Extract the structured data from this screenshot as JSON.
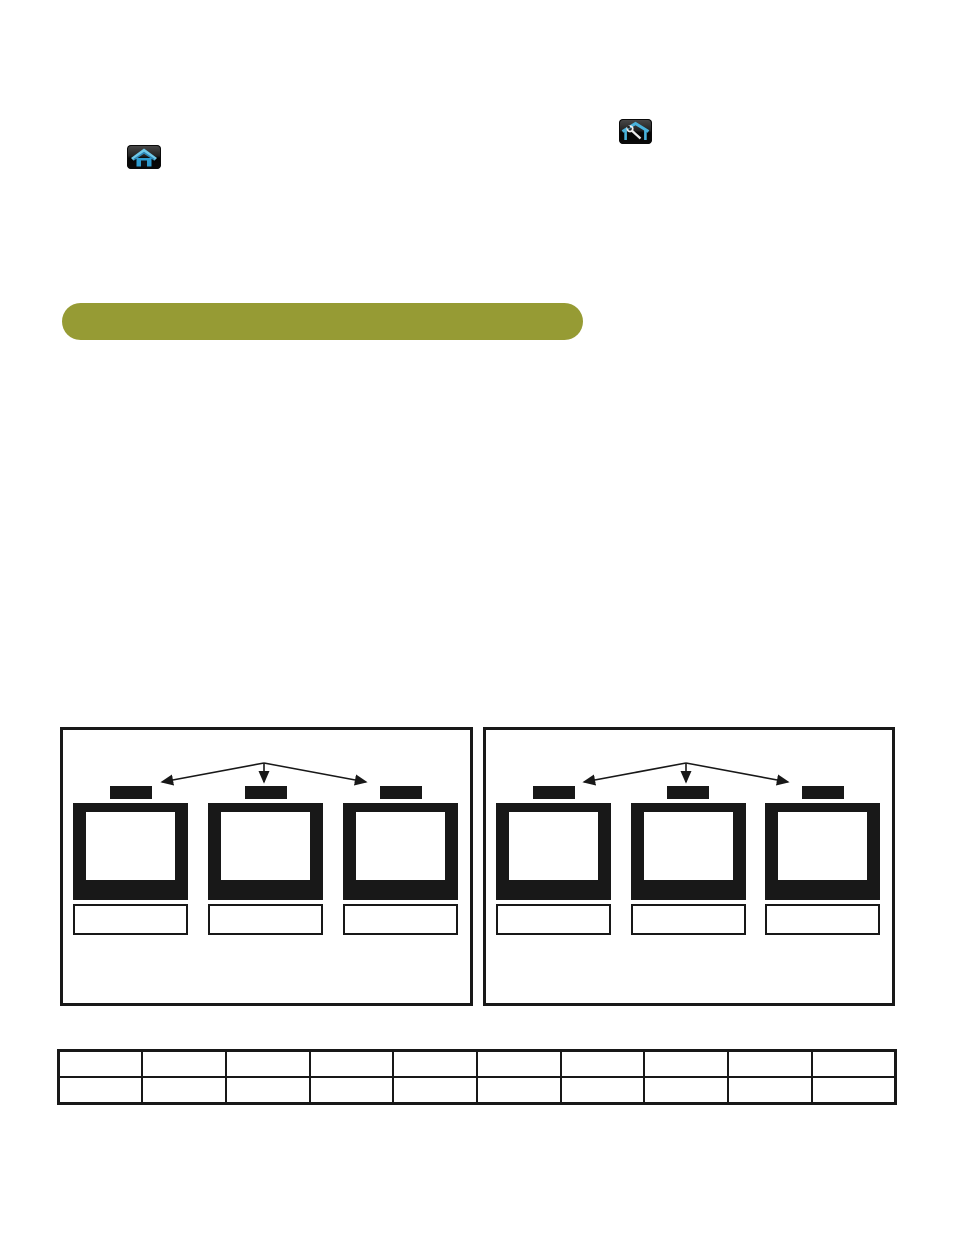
{
  "page": {
    "background": "#ffffff"
  },
  "icons": {
    "home": {
      "name": "home-icon",
      "button_background": "#1a1a1a",
      "roof_color": "#6fc8e9",
      "body_color": "#2d9bd0"
    },
    "home_setup": {
      "name": "home-wrench-icon",
      "button_background": "#1a1a1a",
      "outline_color": "#49b3dc",
      "wrench_color": "#ededed"
    }
  },
  "section_banner": {
    "label": "",
    "color": "#969b34"
  },
  "diagram": {
    "line_color": "#181818",
    "panels": [
      {
        "id": "left",
        "tv_count": 3,
        "labels": [
          "",
          "",
          ""
        ]
      },
      {
        "id": "right",
        "tv_count": 3,
        "labels": [
          "",
          "",
          ""
        ]
      }
    ]
  },
  "table": {
    "columns": 10,
    "rows": [
      [
        "",
        "",
        "",
        "",
        "",
        "",
        "",
        "",
        "",
        ""
      ],
      [
        "",
        "",
        "",
        "",
        "",
        "",
        "",
        "",
        "",
        ""
      ]
    ]
  }
}
